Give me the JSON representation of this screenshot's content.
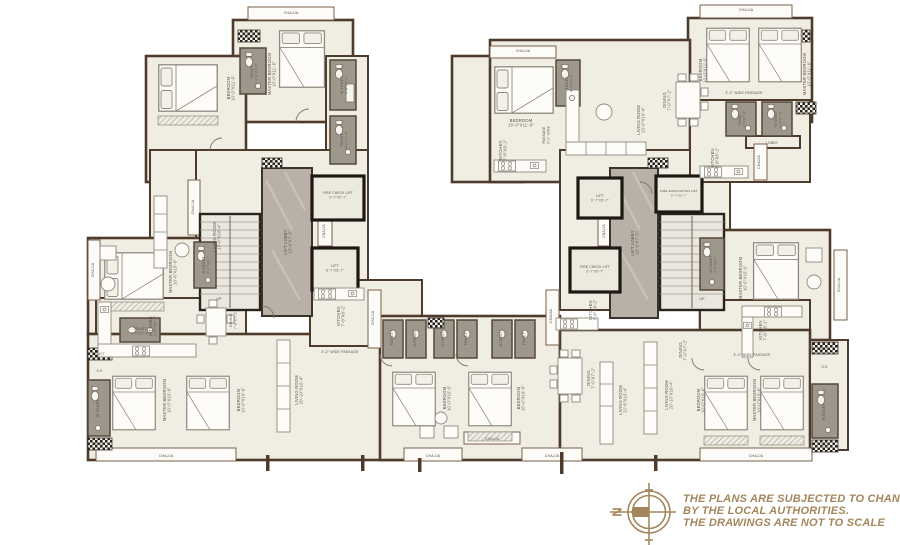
{
  "plan": {
    "colors": {
      "wall": "#4f3b2b",
      "room_fill": "#f0ede3",
      "toilet_fill": "#9d978c",
      "marble_lobby": "#b9b1a8",
      "lift_wall": "#1d1813",
      "accent_gold": "#a3875c"
    },
    "compass": {
      "north_label": "N"
    },
    "disclaimer": {
      "lines": [
        "THE PLANS ARE SUBJECTED TO CHANGE",
        "BY THE LOCAL AUTHORITIES.",
        "THE DRAWINGS ARE NOT TO SCALE"
      ]
    },
    "labels": [
      {
        "t": "CHAJJA",
        "x": 291,
        "y": 14,
        "s": 3.6
      },
      {
        "t": "DUCT",
        "x": 249,
        "y": 36,
        "s": 3.4
      },
      {
        "t": "TOILET",
        "d": "4'-0\"X7'-6\"",
        "x": 253,
        "y": 72,
        "r": -90,
        "s": 3.5
      },
      {
        "t": "MASTER BEDROOM",
        "d": "10'-0\"X11'-6\"",
        "x": 271,
        "y": 74,
        "r": -90
      },
      {
        "t": "M.TOILET",
        "d": "4'-0\"X7'-6\"",
        "x": 343,
        "y": 85,
        "r": -90,
        "s": 3.5
      },
      {
        "t": "TOILET",
        "d": "4'-0\"X7'-6\"",
        "x": 343,
        "y": 140,
        "r": -90,
        "s": 3.5
      },
      {
        "t": "BEDROOM",
        "d": "10'-0\"X11'-0\"",
        "x": 230,
        "y": 88,
        "r": -90
      },
      {
        "t": "LIVING ROOM",
        "d": "13'-0\"X10'-4\"",
        "x": 216,
        "y": 237,
        "r": -90
      },
      {
        "t": "CHAJJA",
        "x": 194,
        "y": 207,
        "r": -90,
        "s": 3.6
      },
      {
        "t": "MASTER BEDROOM",
        "d": "10'-6\"X10'-0\"",
        "x": 172,
        "y": 272,
        "r": -90
      },
      {
        "t": "M.TOILET",
        "d": "7'-0\"X4'-0\"",
        "x": 205,
        "y": 265,
        "r": -90,
        "s": 3.4
      },
      {
        "t": "KITCHEN",
        "d": "7'-8\"X8'-1\"",
        "x": 152,
        "y": 326,
        "r": -90
      },
      {
        "t": "DINING",
        "d": "7'-0\"X7'-2\"",
        "x": 232,
        "y": 320,
        "r": -90,
        "s": 3.6
      },
      {
        "t": "CHAJJA",
        "x": 94,
        "y": 270,
        "r": -90,
        "s": 3.6
      },
      {
        "t": "DUCT",
        "x": 100,
        "y": 355,
        "s": 3.4
      },
      {
        "t": "S.S.",
        "x": 100,
        "y": 372,
        "s": 3.4
      },
      {
        "t": "TOILET",
        "d": "4'-0\"X7'-6\"",
        "x": 140,
        "y": 330,
        "s": 3.5
      },
      {
        "t": "M.TOILET",
        "x": 99,
        "y": 408,
        "r": -90,
        "s": 3.5
      },
      {
        "t": "DUCT",
        "x": 100,
        "y": 445,
        "s": 3.4
      },
      {
        "t": "MASTER BEDROOM",
        "d": "10'-0\"X10'-6\"",
        "x": 166,
        "y": 400,
        "r": -90
      },
      {
        "t": "BEDROOM",
        "d": "10'-0\"X10'-6\"",
        "x": 240,
        "y": 400,
        "r": -90
      },
      {
        "t": "CHAJJA",
        "x": 166,
        "y": 457,
        "s": 3.6
      },
      {
        "t": "LIVING ROOM",
        "d": "20'-10\"X10'-4\"",
        "x": 298,
        "y": 390,
        "r": -90
      },
      {
        "t": "3'-2\" WIDE PASSAGE",
        "x": 340,
        "y": 353,
        "s": 3.5
      },
      {
        "t": "KITCHEN",
        "d": "7'-8\"X8'-2\"",
        "x": 340,
        "y": 316,
        "r": -90
      },
      {
        "t": "CHAJJA",
        "x": 374,
        "y": 318,
        "r": -90,
        "s": 3.6
      },
      {
        "t": "LIFT LOBBY",
        "d": "13'-6\"X7'-0\"",
        "x": 287,
        "y": 242,
        "r": -90
      },
      {
        "t": "FIRE CHECK LIFT",
        "d": "6'-7\"X5'-7\"",
        "x": 338,
        "y": 194,
        "s": 3.3
      },
      {
        "t": "CHAJJA",
        "x": 325,
        "y": 231,
        "r": -90,
        "s": 3.3
      },
      {
        "t": "LIFT",
        "d": "6'-7\"X5'-7\"",
        "x": 335,
        "y": 267,
        "s": 3.5
      },
      {
        "t": "UP",
        "x": 219,
        "y": 300,
        "s": 3.6
      },
      {
        "t": "DUCT",
        "x": 272,
        "y": 163,
        "s": 3.4
      },
      {
        "t": "TOILET",
        "x": 393,
        "y": 339,
        "r": -90,
        "s": 3.4
      },
      {
        "t": "M.TOILET",
        "x": 416,
        "y": 339,
        "r": -90,
        "s": 3.2
      },
      {
        "t": "M.TOILET",
        "x": 444,
        "y": 339,
        "r": -90,
        "s": 3.2
      },
      {
        "t": "TOILET",
        "x": 467,
        "y": 339,
        "r": -90,
        "s": 3.4
      },
      {
        "t": "BEDROOM",
        "d": "10'-0\"X10'-0\"",
        "x": 446,
        "y": 398,
        "r": -90
      },
      {
        "t": "CHAJJA",
        "x": 433,
        "y": 457,
        "s": 3.6
      },
      {
        "t": "BEDROOM",
        "d": "10'-0\"X10'-0\"",
        "x": 520,
        "y": 398,
        "r": -90
      },
      {
        "t": "CHAJJA",
        "x": 492,
        "y": 440,
        "s": 3.6
      },
      {
        "t": "CHAJJA",
        "x": 552,
        "y": 457,
        "s": 3.6
      },
      {
        "t": "M.TOILET",
        "x": 502,
        "y": 339,
        "r": -90,
        "s": 3.2
      },
      {
        "t": "TOILET",
        "x": 525,
        "y": 339,
        "r": -90,
        "s": 3.4
      },
      {
        "t": "CHAJJA",
        "x": 746,
        "y": 11,
        "s": 3.6
      },
      {
        "t": "BEDROOM",
        "d": "10'-0\"X11'-0\"",
        "x": 702,
        "y": 70,
        "r": -90
      },
      {
        "t": "MASTER BEDROOM",
        "d": "10'-0\"X11'-6\"",
        "x": 806,
        "y": 74,
        "r": -90
      },
      {
        "t": "CHAJJA",
        "x": 523,
        "y": 52,
        "s": 3.6
      },
      {
        "t": "BEDROOM",
        "d": "10'-0\"X11'-0\"",
        "x": 521,
        "y": 122
      },
      {
        "t": "TOILET",
        "d": "4'-0\"X7'-6\"",
        "x": 568,
        "y": 83,
        "r": -90,
        "s": 3.5
      },
      {
        "t": "PASSAGE",
        "d": "3'-2\" WIDE",
        "x": 545,
        "y": 135,
        "r": -90,
        "s": 3.4
      },
      {
        "t": "KITCHEN",
        "d": "7'-8\"X8'-2\"",
        "x": 502,
        "y": 150,
        "r": -90
      },
      {
        "t": "LIVING ROOM",
        "d": "13'-0\"X10'-4\"",
        "x": 640,
        "y": 120,
        "r": -90
      },
      {
        "t": "DINING",
        "d": "7'-0\"X7'-2\"",
        "x": 666,
        "y": 100,
        "r": -90
      },
      {
        "t": "3'-2\" WIDE PASSAGE",
        "x": 744,
        "y": 94,
        "s": 3.5
      },
      {
        "t": "TOILET",
        "d": "4'-0\"X7'-6\"",
        "x": 741,
        "y": 119,
        "r": -90,
        "s": 3.3
      },
      {
        "t": "M.TOILET",
        "d": "4'-0\"X7'-6\"",
        "x": 777,
        "y": 119,
        "r": -90,
        "s": 3.2
      },
      {
        "t": "LOBBY",
        "x": 772,
        "y": 144,
        "s": 3.5
      },
      {
        "t": "DUCT",
        "x": 806,
        "y": 109,
        "s": 3.4
      },
      {
        "t": "KITCHEN",
        "d": "7'-8\"X8'-2\"",
        "x": 714,
        "y": 158,
        "r": -90
      },
      {
        "t": "CHAJJA",
        "x": 760,
        "y": 162,
        "r": -90,
        "s": 3.4
      },
      {
        "t": "LIFT",
        "d": "6'-7\"X5'-7\"",
        "x": 600,
        "y": 197,
        "s": 3.5
      },
      {
        "t": "CHAJJA",
        "x": 605,
        "y": 231,
        "r": -90,
        "s": 3.3
      },
      {
        "t": "FIRE CHECK LIFT",
        "d": "6'-7\"X5'-7\"",
        "x": 595,
        "y": 268,
        "s": 3.3
      },
      {
        "t": "LIFT LOBBY",
        "d": "13'-6\"X7'-0\"",
        "x": 634,
        "y": 243,
        "r": -90
      },
      {
        "t": "FIRE EVACUATION LIFT",
        "d": "6'-7\"X5'-7\"",
        "x": 679,
        "y": 192,
        "s": 3.1
      },
      {
        "t": "UP",
        "x": 702,
        "y": 300,
        "s": 3.6
      },
      {
        "t": "M.TOILET",
        "d": "7'-0\"X4'-0\"",
        "x": 712,
        "y": 264,
        "r": -90,
        "s": 3.4
      },
      {
        "t": "MASTER BEDROOM",
        "d": "10'-6\"X10'-0\"",
        "x": 742,
        "y": 278,
        "r": -90
      },
      {
        "t": "CHAJJA",
        "x": 840,
        "y": 285,
        "r": -90,
        "s": 3.6
      },
      {
        "t": "KITCHEN",
        "d": "7'-8\"X8'-1\"",
        "x": 762,
        "y": 330,
        "r": -90
      },
      {
        "t": "3'-2\" WIDE PASSAGE",
        "x": 752,
        "y": 356,
        "s": 3.5
      },
      {
        "t": "DINING",
        "d": "7'-0\"X7'-2\"",
        "x": 682,
        "y": 350,
        "r": -90
      },
      {
        "t": "LIVING ROOM",
        "d": "20'-10\"X10'-4\"",
        "x": 668,
        "y": 395,
        "r": -90
      },
      {
        "t": "BEDROOM",
        "d": "10'-0\"X10'-6\"",
        "x": 700,
        "y": 400,
        "r": -90
      },
      {
        "t": "MASTER BEDROOM",
        "d": "10'-0\"X10'-6\"",
        "x": 756,
        "y": 400,
        "r": -90
      },
      {
        "t": "CHAJJA",
        "x": 756,
        "y": 457,
        "s": 3.6
      },
      {
        "t": "DUCT",
        "x": 825,
        "y": 350,
        "s": 3.4
      },
      {
        "t": "S.S.",
        "x": 825,
        "y": 368,
        "s": 3.4
      },
      {
        "t": "M.TOILET",
        "x": 825,
        "y": 412,
        "r": -90,
        "s": 3.4
      },
      {
        "t": "DUCT",
        "x": 825,
        "y": 446,
        "s": 3.4
      },
      {
        "t": "KITCHEN",
        "d": "7'-8\"X8'-2\"",
        "x": 592,
        "y": 310,
        "r": -90
      },
      {
        "t": "CHAJJA",
        "x": 552,
        "y": 316,
        "r": -90,
        "s": 3.4
      },
      {
        "t": "DINING",
        "d": "7'-0\"X7'-2\"",
        "x": 590,
        "y": 378,
        "r": -90
      },
      {
        "t": "LIVING ROOM",
        "d": "12'-6\"X10'-4\"",
        "x": 622,
        "y": 400,
        "r": -90
      }
    ]
  }
}
